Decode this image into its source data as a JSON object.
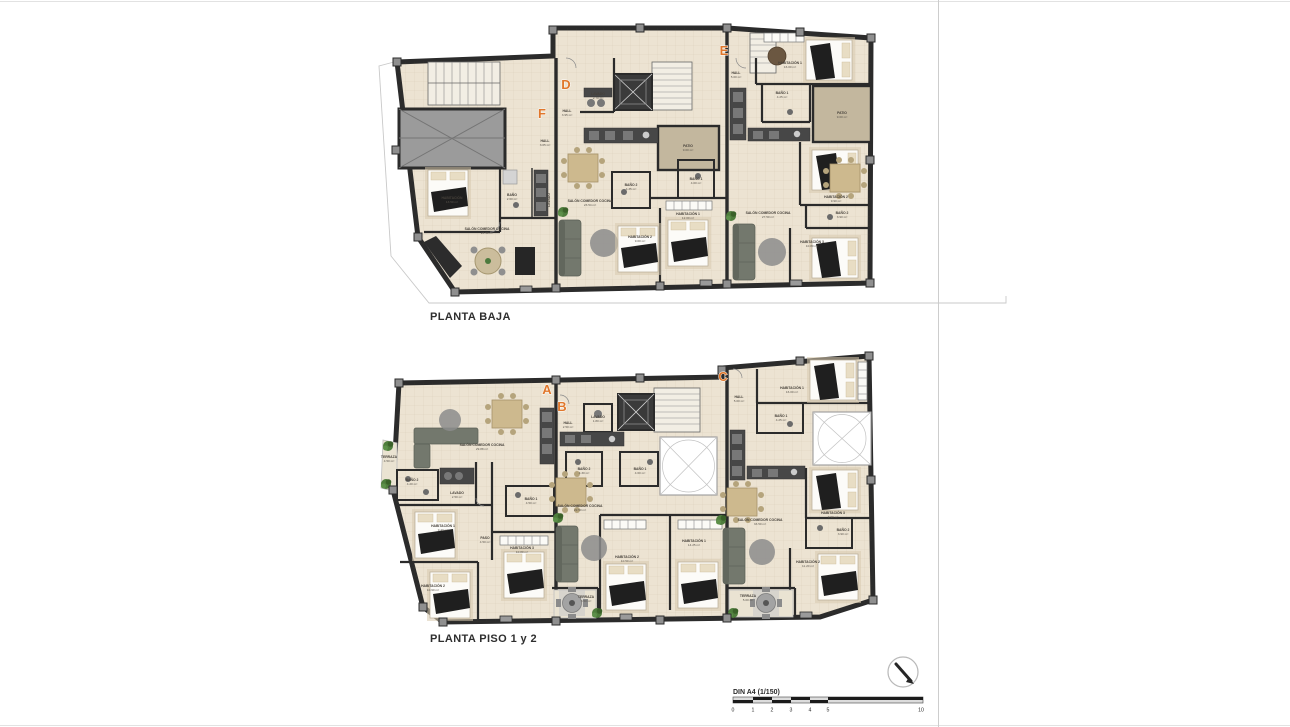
{
  "plans": [
    {
      "title": "PLANTA BAJA",
      "units": [
        {
          "letter": "F",
          "rooms": [
            {
              "n": "HALL",
              "a": "3.05 m²"
            },
            {
              "n": "HABITACIÓN",
              "a": "13.50 m²"
            },
            {
              "n": "BAÑO",
              "a": "2.60 m²"
            },
            {
              "n": "LAVADO",
              "a": ""
            },
            {
              "n": "SALÓN COMEDOR COCINA",
              "a": "24.50 m²"
            }
          ]
        },
        {
          "letter": "D",
          "rooms": [
            {
              "n": "LAVADO",
              "a": "2.70 m²"
            },
            {
              "n": "HALL",
              "a": "3.95 m²"
            },
            {
              "n": "PATIO",
              "a": "9.00 m²"
            },
            {
              "n": "SALÓN COMEDOR COCINA",
              "a": "23.54 m²"
            },
            {
              "n": "BAÑO 2",
              "a": "4.35 m²"
            },
            {
              "n": "BAÑO 1",
              "a": "4.00 m²"
            },
            {
              "n": "HABITACIÓN 1",
              "a": "12.00 m²"
            },
            {
              "n": "HABITACIÓN 2",
              "a": "9.00 m²"
            }
          ]
        },
        {
          "letter": "E",
          "rooms": [
            {
              "n": "HALL",
              "a": "5.00 m²"
            },
            {
              "n": "HABITACIÓN 1",
              "a": "16.00 m²"
            },
            {
              "n": "BAÑO 1",
              "a": "4.25 m²"
            },
            {
              "n": "PATIO",
              "a": "9.00 m²"
            },
            {
              "n": "SALÓN COMEDOR COCINA",
              "a": "27.50 m²"
            },
            {
              "n": "HABITACIÓN 2",
              "a": "9.90 m²"
            },
            {
              "n": "BAÑO 2",
              "a": "3.90 m²"
            },
            {
              "n": "HABITACIÓN 3",
              "a": "10.80 m²"
            }
          ]
        }
      ]
    },
    {
      "title": "PLANTA PISO 1 y 2",
      "units": [
        {
          "letter": "A",
          "rooms": [
            {
              "n": "TERRAZA",
              "a": "4.50 m²"
            },
            {
              "n": "SALÓN COMEDOR COCINA",
              "a": "29.88 m²"
            },
            {
              "n": "BAÑO 2",
              "a": "4.20 m²"
            },
            {
              "n": "LAVADO",
              "a": "2.50 m²"
            },
            {
              "n": "HABITACIÓN 1",
              "a": "9.40 m²"
            },
            {
              "n": "PASO",
              "a": "4.50 m²"
            },
            {
              "n": "BAÑO 1",
              "a": "4.50 m²"
            },
            {
              "n": "HABITACIÓN 3",
              "a": "10.80 m²"
            },
            {
              "n": "HABITACIÓN 2",
              "a": "10.90 m²"
            }
          ]
        },
        {
          "letter": "B",
          "rooms": [
            {
              "n": "HALL",
              "a": "2.50 m²"
            },
            {
              "n": "LAVADO",
              "a": "1.80 m²"
            },
            {
              "n": "SALÓN COMEDOR COCINA",
              "a": "22.50 m²"
            },
            {
              "n": "BAÑO 2",
              "a": "4.30 m²"
            },
            {
              "n": "BAÑO 1",
              "a": "4.60 m²"
            },
            {
              "n": "HABITACIÓN 2",
              "a": "10.50 m²"
            },
            {
              "n": "HABITACIÓN 1",
              "a": "14.25 m²"
            },
            {
              "n": "TERRAZA",
              "a": "3.50 m²"
            }
          ]
        },
        {
          "letter": "C",
          "rooms": [
            {
              "n": "HALL",
              "a": "5.00 m²"
            },
            {
              "n": "HABITACIÓN 1",
              "a": "16.00 m²"
            },
            {
              "n": "BAÑO 1",
              "a": "4.25 m²"
            },
            {
              "n": "SALÓN COMEDOR COCINA",
              "a": "33.50 m²"
            },
            {
              "n": "HABITACIÓN 3",
              "a": "9.90 m²"
            },
            {
              "n": "BAÑO 2",
              "a": "3.90 m²"
            },
            {
              "n": "HABITACIÓN 2",
              "a": "11.20 m²"
            },
            {
              "n": "TERRAZA",
              "a": "5.00 m²"
            }
          ]
        }
      ]
    }
  ],
  "legend": {
    "scale_label": "DIN A4 (1/150)",
    "ticks": [
      "0",
      "1",
      "2",
      "3",
      "4",
      "5",
      "10"
    ]
  },
  "colors": {
    "wall": "#2b2b2b",
    "floor": "#ece3d2",
    "patio": "#c3b79e",
    "unit_letter": "#e0772b"
  }
}
